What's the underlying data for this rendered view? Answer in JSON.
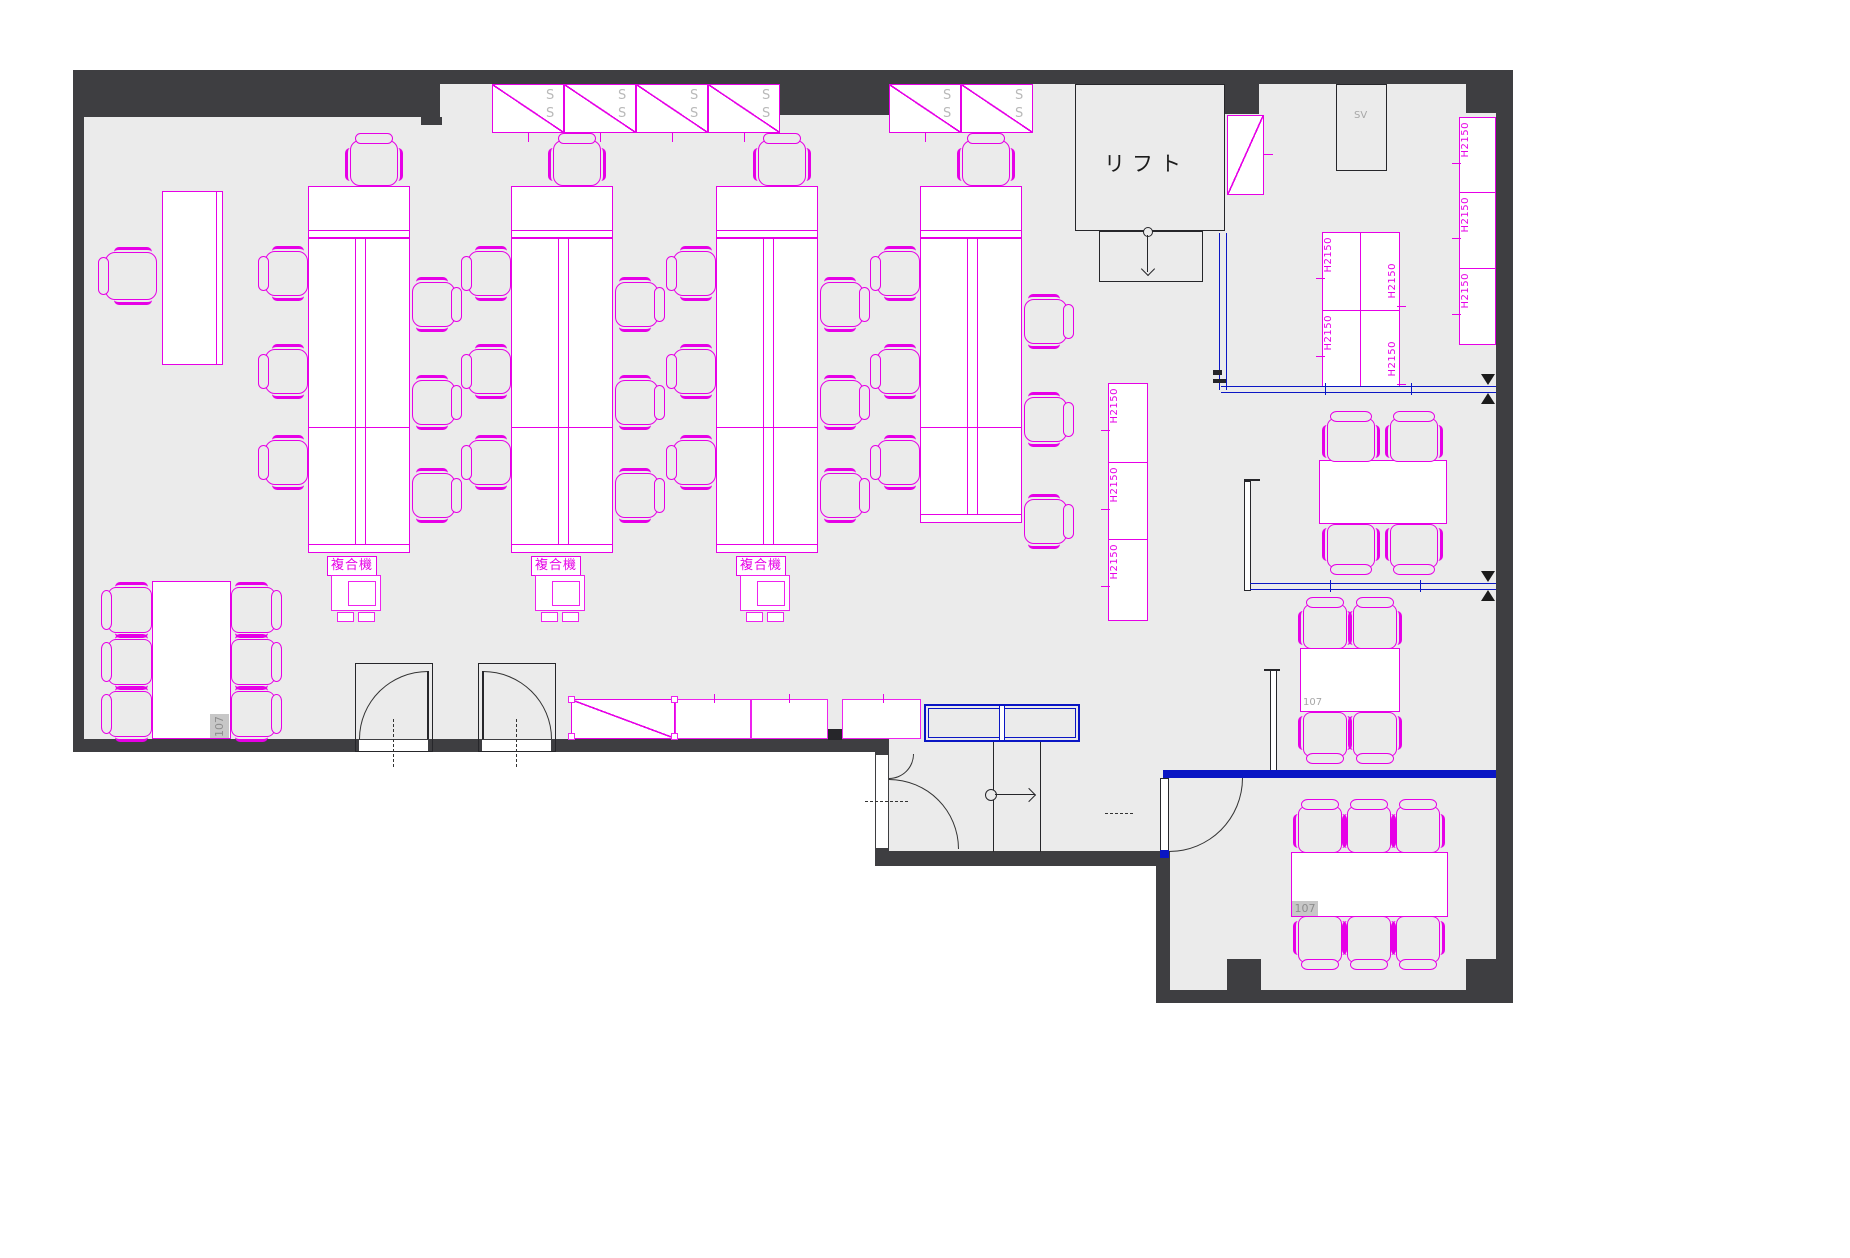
{
  "plan": {
    "type": "office-floor-plan-cad",
    "colors": {
      "wall": "#3e3e41",
      "floor": "#ebebeb",
      "furniture_line": "#e600e6",
      "partition_blue": "#0a16c4",
      "drawing_line": "#26262a",
      "muted_text": "#a7a7a7"
    },
    "rooms": {
      "lift_label": "リフト"
    },
    "equipment": {
      "copier_label": "複合機",
      "server_label": "SV",
      "shelf_letter": "S",
      "cabinet_height_label": "H2150"
    },
    "room_numbers": {
      "number": "107"
    }
  }
}
